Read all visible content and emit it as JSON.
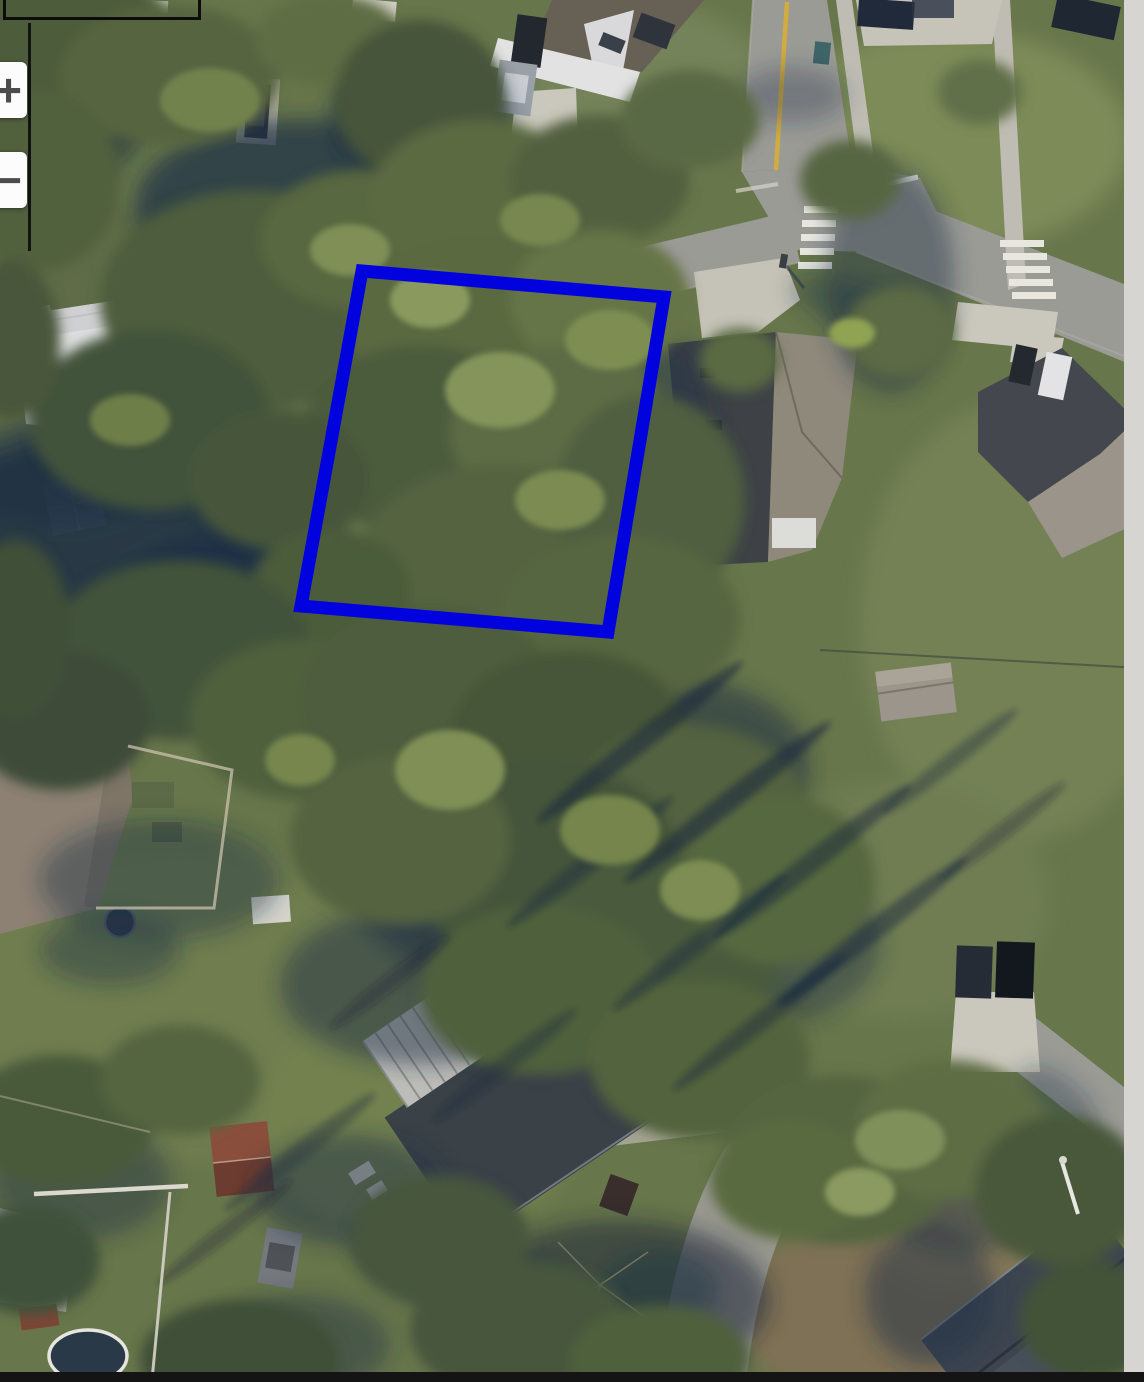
{
  "viewport": {
    "width": 1144,
    "height": 1382
  },
  "controls": {
    "zoom_in_label": "+",
    "zoom_out_label": "−"
  },
  "overlays": {
    "parcel": {
      "points": "362,271 664,297 608,632 301,606",
      "color": "#0202df",
      "stroke_width": 13
    },
    "annotation_rect_color": "#0c0c0c",
    "annotation_line_color": "#131313"
  },
  "chrome": {
    "right_strip_color": "#d6d5d1",
    "bottom_bar_color": "#141414",
    "button_bg": "#fcfcfc",
    "button_glyph_color": "#4c4c4c"
  },
  "scene": {
    "type": "aerial-photo",
    "setting": "suburban residential neighborhood, wooded vacant lot outlined in blue",
    "palette": {
      "grass": "#68764b",
      "canopy": "#53633f",
      "canopy_shadow": "#1f3046",
      "road": "#9b9b96",
      "concrete": "#cac7bc",
      "sidewalk": "#bfbdb3",
      "roof_dark": "#44484e",
      "roof_light": "#8f897c",
      "roof_white": "#dfdfe1",
      "roof_metal": "#bcbcb8",
      "roof_rust": "#8a4f3c",
      "yellow_line": "#d2ac40",
      "dirt": "#7f7154"
    },
    "features": [
      "street with yellow center line entering from top",
      "curved intersection with stop line and two white crosswalks",
      "side street heading southwest under tree canopy",
      "wooded vacant parcel outlined in blue",
      "houses with gray, white, tan and metal roofs",
      "concrete driveways with parked cars",
      "dense tree canopy with long pine shadows",
      "above-ground pool, sheds and fenced backyards",
      "curving road at bottom center",
      "dirt patch and dark-roofed house at bottom right"
    ]
  }
}
